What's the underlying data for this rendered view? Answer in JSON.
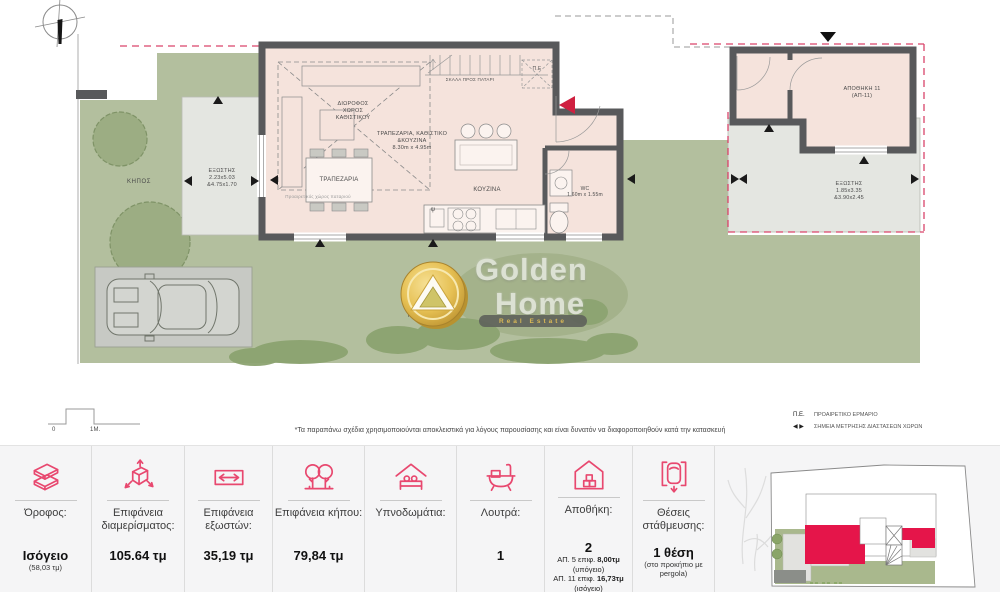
{
  "plan": {
    "labels": {
      "garden_left": "ΚΗΠΟΣ",
      "balcony_left": "ΕΞΩΣΤΗΣ\n2.23x5.03\n&4.75x1.70",
      "double_height": "ΔΙΩΡΟΦΟΣ\nΧΩΡΟΣ\nΚΑΘΙΣΤΙΚΟΥ",
      "loft_note": "Προαιρετικός χώρος παταριού",
      "stairs": "ΣΚΑΛΑ ΠΡΟΣ ΠΑΤΑΡΙ",
      "pe_box": "Π.Ε",
      "living_block": "ΤΡΑΠΕΖΑΡΙΑ, ΚΑΘΙΣΤΙΚΟ\n&ΚΟΥΖΙΝΑ\n8.30m x 4.95m",
      "dining": "ΤΡΑΠΕΖΑΡΙΑ",
      "kitchen": "ΚΟΥΖΙΝΑ",
      "kitchen_sink": "ψ",
      "wc": "WC\n1.60m x 1.55m",
      "storage": "ΑΠΟΘΗΚΗ 11\n(ΑΠ-11)",
      "balcony_right": "ΕΞΩΣΤΗΣ\n1.85x3.35\n&3.90x2.45",
      "garden_center": "ΚΗΠΟΣ"
    },
    "scale": {
      "zero": "0",
      "one": "1Μ."
    },
    "footnote": "*Τα παραπάνω σχέδια χρησιμοποιούνται αποκλειστικά για λόγους παρουσίασης και είναι δυνατόν να διαφοροποιηθούν κατά την κατασκευή",
    "legend": {
      "pe_abbr": "Π.Ε.",
      "pe_text": "ΠΡΟΑΙΡΕΤΙΚΟ ΕΡΜΑΡΙΟ",
      "arrows_glyph": "◀ ▶",
      "arrows_text": "ΣΗΜΕΙΑ ΜΕΤΡΗΣΗΣ ΔΙΑΣΤΑΣΕΩΝ ΧΩΡΩΝ"
    }
  },
  "logo": {
    "word1": "Golden",
    "word2": "Home",
    "banner": "Real Estate"
  },
  "stats": [
    {
      "label": "Όροφος:",
      "value": "Ισόγειο",
      "note": "(58,03 τμ)"
    },
    {
      "label": "Επιφάνεια\nδιαμερίσματος:",
      "value": "105.64 τμ",
      "note": ""
    },
    {
      "label": "Επιφάνεια\nεξωστών:",
      "value": "35,19 τμ",
      "note": ""
    },
    {
      "label": "Επιφάνεια κήπου:",
      "value": "79,84 τμ",
      "note": ""
    },
    {
      "label": "Υπνοδωμάτια:",
      "value": "",
      "note": ""
    },
    {
      "label": "Λουτρά:",
      "value": "1",
      "note": ""
    },
    {
      "label": "Αποθήκη:",
      "value": "2",
      "details": [
        {
          "prefix": "ΑΠ. 5 επιφ. ",
          "strong": "8,00τμ"
        },
        {
          "prefix": "(υπόγειο)",
          "strong": ""
        },
        {
          "prefix": "ΑΠ. 11 επιφ. ",
          "strong": "16,73τμ"
        },
        {
          "prefix": "(ισόγειο)",
          "strong": ""
        }
      ]
    },
    {
      "label": "Θέσεις\nστάθμευσης:",
      "value": "1 θέση",
      "note": "(στο προκήπιο με\npergola)"
    }
  ],
  "colors": {
    "accent_pink": "#e8486f",
    "plan_entrance_red": "#cf2040",
    "boundary_dashed_red": "#d9446a",
    "wall_gray": "#58595b",
    "garden_green": "#b3bf9e",
    "keyplan_red": "#e5154a"
  }
}
